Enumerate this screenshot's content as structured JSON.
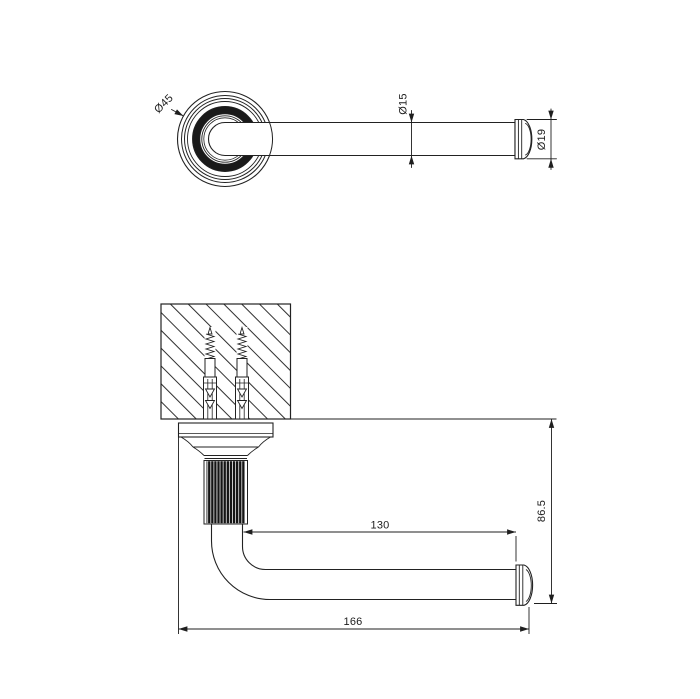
{
  "page": {
    "background": "#ffffff",
    "line_color": "#1f1f1f",
    "knurl_color": "#141414"
  },
  "front_view": {
    "labels": {
      "rosette_diameter": "Ø45",
      "tube_diameter": "Ø15",
      "cap_diameter": "Ø19"
    }
  },
  "side_view": {
    "labels": {
      "arm_length": "130",
      "wall_to_bar_height": "86.5",
      "overall_length": "166"
    }
  }
}
